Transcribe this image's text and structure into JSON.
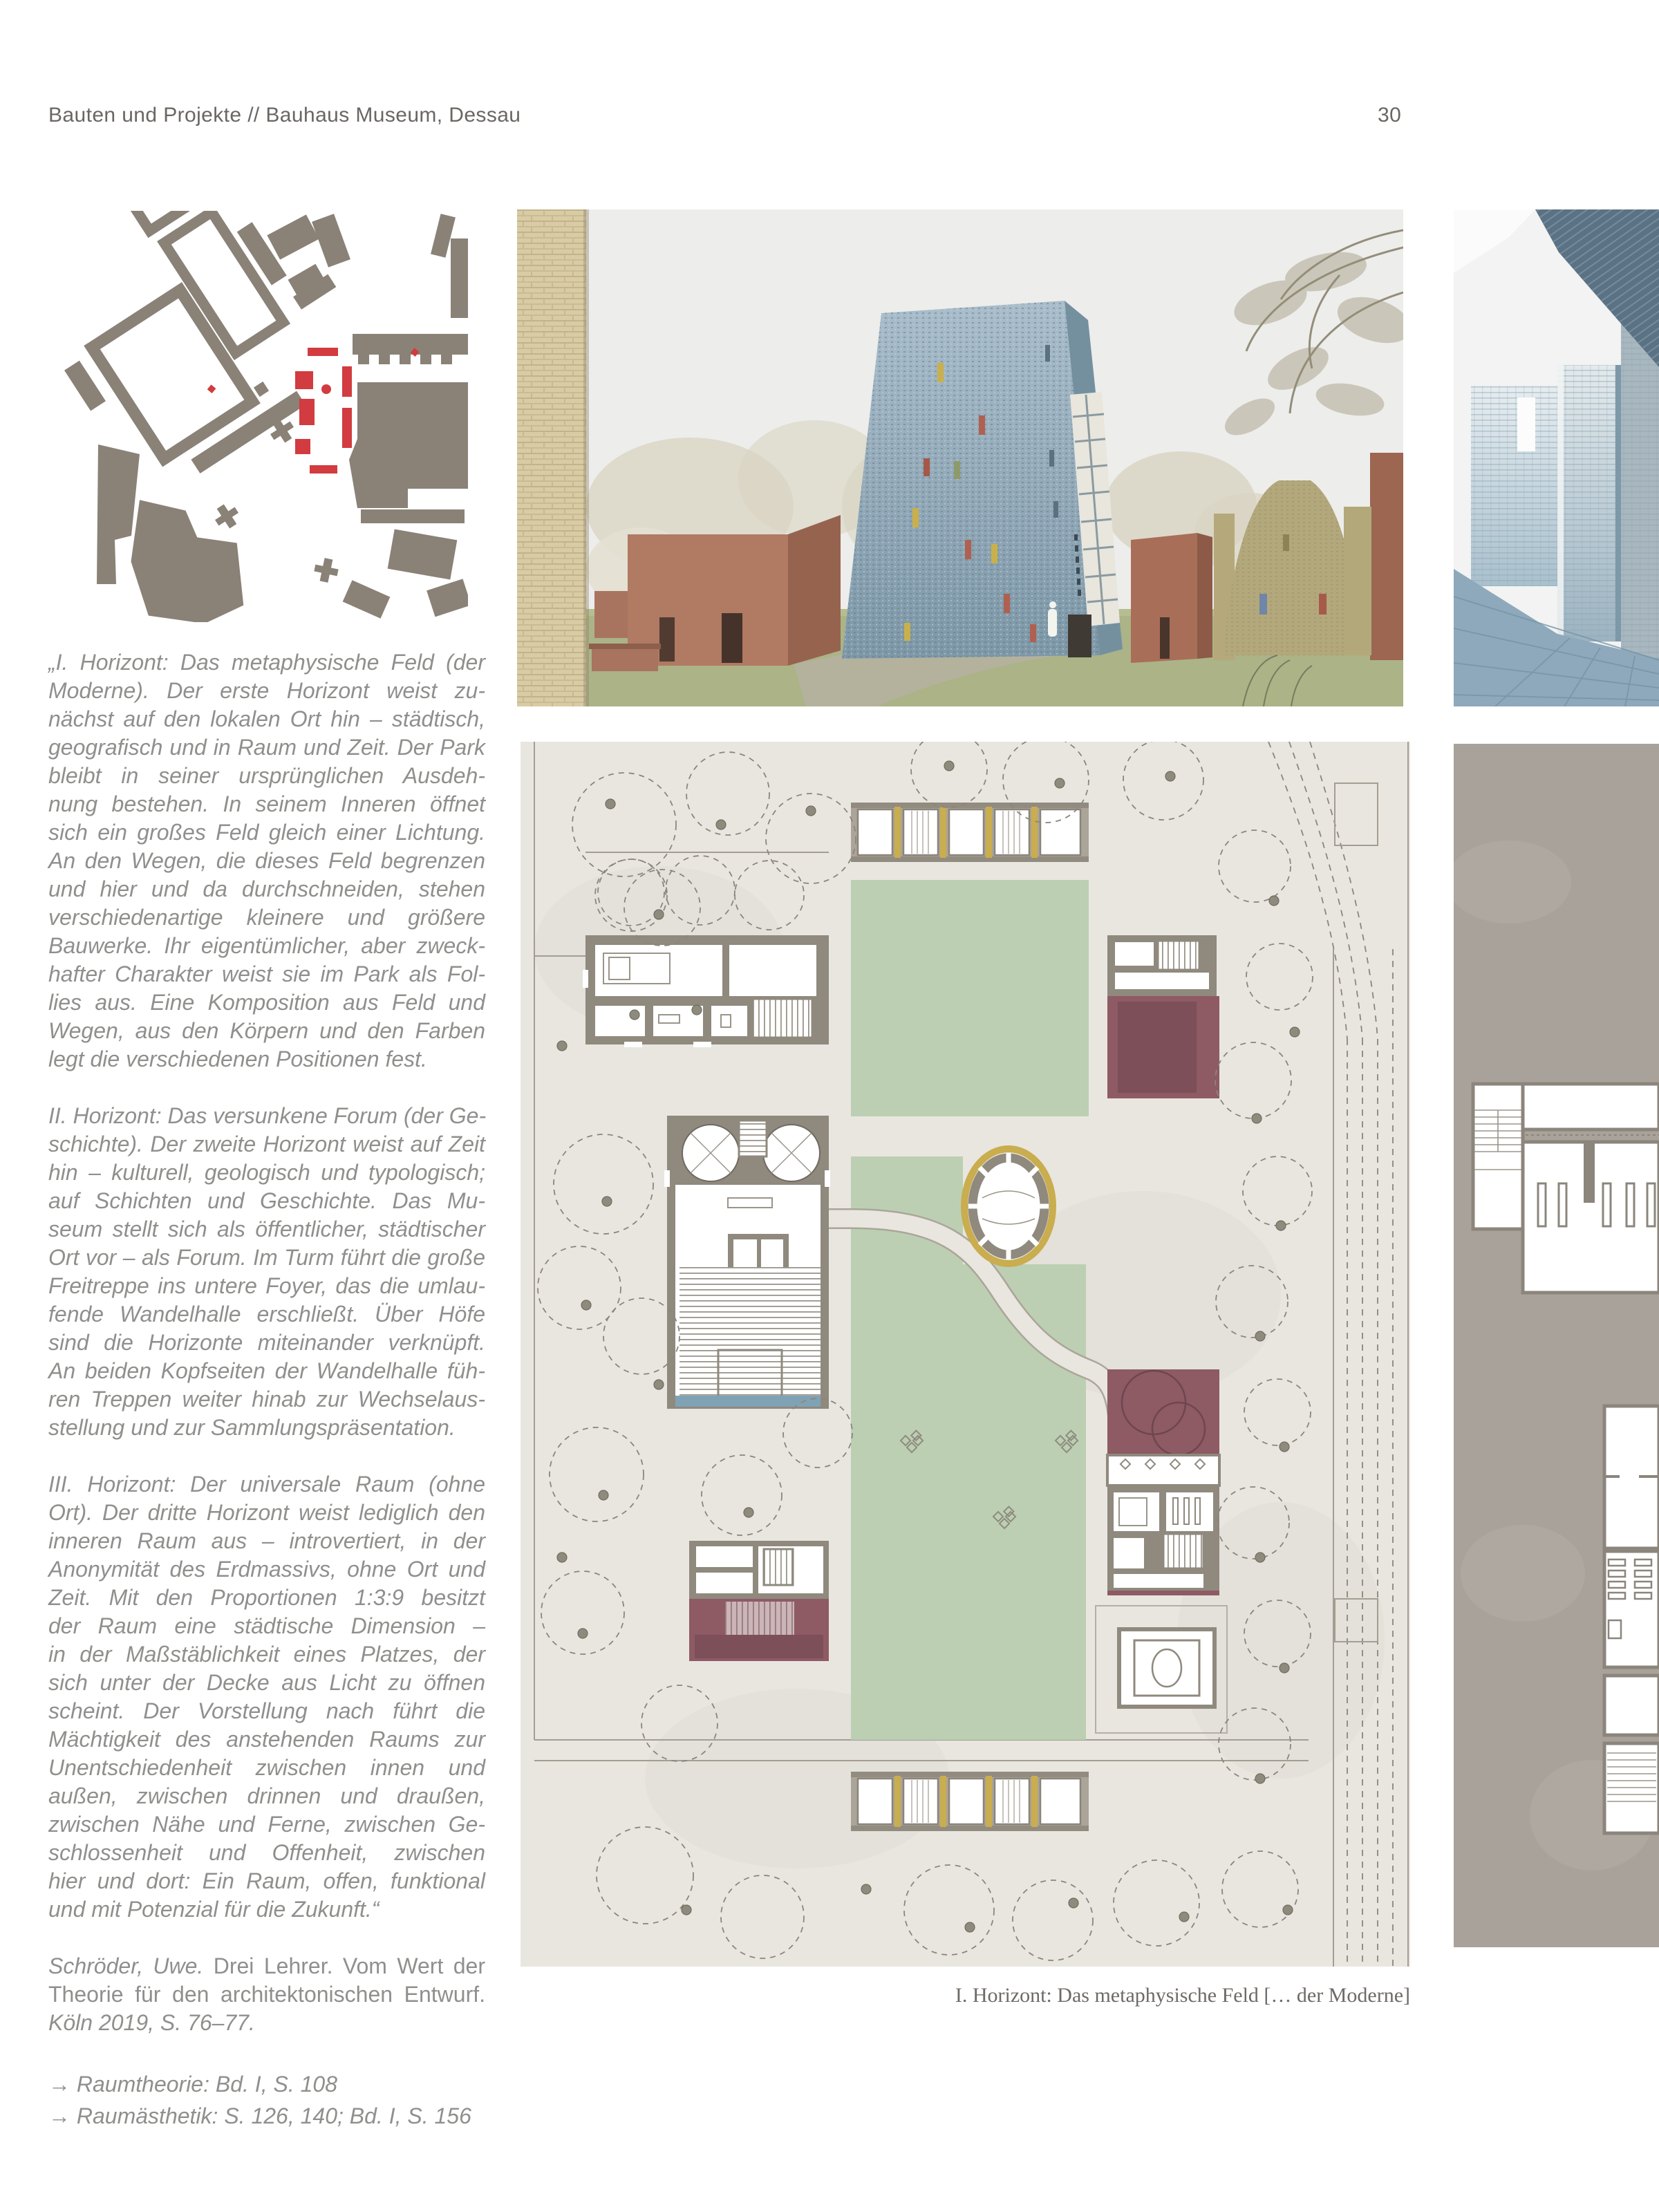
{
  "header": {
    "title": "Bauten und Projekte // Bauhaus Museum, Dessau",
    "page_number": "30"
  },
  "quote": {
    "paragraph_1_lines": [
      "„I. Horizont: Das metaphysische Feld (der",
      "Moderne). Der erste Horizont weist zu-",
      "nächst auf den lokalen Ort hin – städtisch,",
      "geografisch und in Raum und Zeit. Der Park",
      "bleibt in seiner ursprünglichen Ausdeh-",
      "nung bestehen. In seinem Inneren öffnet",
      "sich ein großes Feld gleich einer Lichtung.",
      "An den Wegen, die dieses Feld begrenzen",
      "und hier und da durchschneiden, stehen",
      "verschiedenartige kleinere und größere",
      "Bauwerke. Ihr eigentümlicher, aber zweck-",
      "hafter Charakter weist sie im Park als Fol-",
      "lies aus. Eine Komposition aus Feld und",
      "Wegen, aus den Körpern und den Farben",
      "legt die verschiedenen Positionen fest."
    ],
    "paragraph_2_lines": [
      "II. Horizont: Das versunkene Forum (der Ge-",
      "schichte). Der zweite Horizont weist auf Zeit",
      "hin – kulturell, geologisch und typologisch;",
      "auf Schichten und Geschichte. Das Mu-",
      "seum stellt sich als öffentlicher, städtischer",
      "Ort vor – als Forum. Im Turm führt die große",
      "Freitreppe ins untere Foyer, das die umlau-",
      "fende Wandelhalle erschließt. Über Höfe",
      "sind die Horizonte miteinander verknüpft.",
      "An beiden Kopfseiten der Wandelhalle füh-",
      "ren Treppen weiter hinab zur Wechselaus-",
      "stellung und zur Sammlungspräsentation."
    ],
    "paragraph_3_lines": [
      "III. Horizont: Der universale Raum (ohne",
      "Ort). Der dritte Horizont weist lediglich den",
      "inneren Raum aus – introvertiert, in der",
      "Anonymität des Erdmassivs, ohne Ort und",
      "Zeit. Mit den Proportionen 1:3:9 besitzt",
      "der Raum eine städtische Dimension –",
      "in der Maßstäblichkeit eines Platzes, der",
      "sich unter der Decke aus Licht zu öffnen",
      "scheint. Der Vorstellung nach führt die",
      "Mächtigkeit des anstehenden Raums zur",
      "Unentschiedenheit zwischen innen und",
      "außen, zwischen drinnen und draußen,",
      "zwischen Nähe und Ferne, zwischen Ge-",
      "schlossenheit und Offenheit, zwischen",
      "hier und dort: Ein Raum, offen, funktional",
      "und mit Potenzial für die Zukunft.“"
    ]
  },
  "citation": {
    "lines": [
      [
        {
          "t": "Schröder, Uwe.",
          "it": true
        },
        {
          "t": " Drei Lehrer. Vom Wert der",
          "it": false
        }
      ],
      [
        {
          "t": "Theorie für den architektonischen Entwurf.",
          "it": false
        }
      ],
      [
        {
          "t": "Köln 2019, S. 76–77.",
          "it": true
        }
      ]
    ]
  },
  "references": [
    "→ Raumtheorie: Bd. I, S. 108",
    "→ Raumästhetik: S. 126, 140; Bd. I, S. 156"
  ],
  "caption": "I. Horizont: Das metaphysische Feld [… der Moderne]",
  "colors": {
    "highlight_red": "#d23b3f",
    "map_building_grey": "#8a8177",
    "plan_paper": "#e9e6e0",
    "plan_green": "#bccfb2",
    "plan_maroon": "#8e5a64",
    "accent_yellow": "#c9ad4e",
    "water_blue": "#7fa3b5",
    "concrete_grey": "#a8a29b",
    "body_text_grey": "#8f8f8d"
  }
}
